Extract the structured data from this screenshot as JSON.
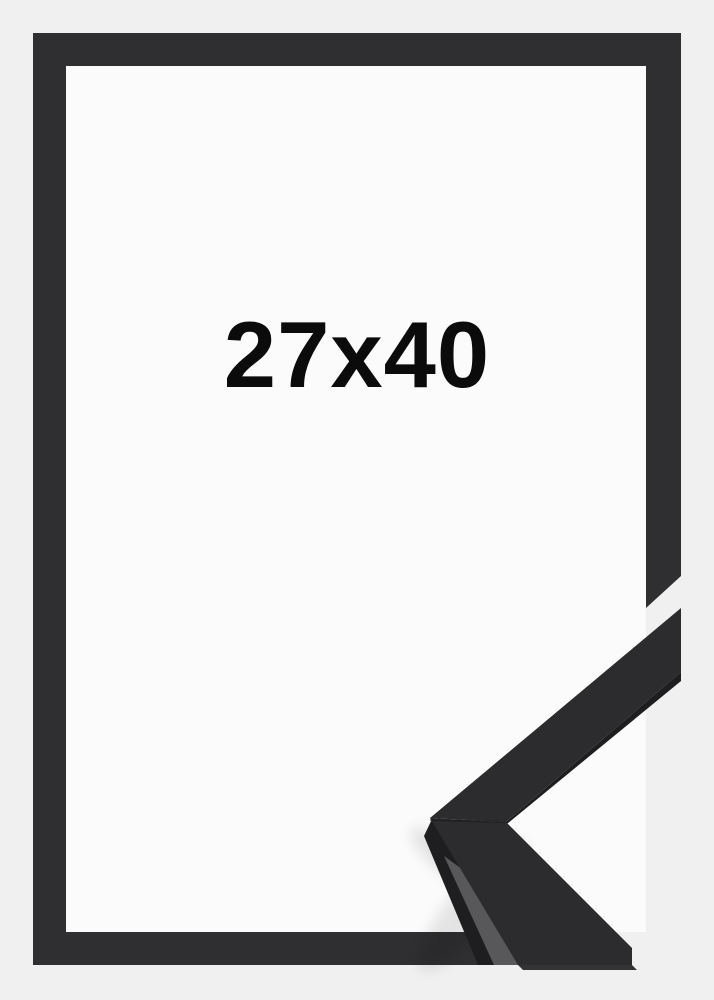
{
  "product": {
    "size_label": "27x40"
  },
  "graphic": {
    "frame_name": "black-picture-frame",
    "corner_sample_name": "moulding-corner-profile-sample"
  },
  "colors": {
    "background": "#f0f0f1",
    "inner": "#fbfbfb",
    "frame": "#2f2f31",
    "sample_face": "#2c2c2e",
    "dark_edge": "#1e1e20",
    "side_light": "#58585a",
    "label_text": "#0b0b0b"
  }
}
